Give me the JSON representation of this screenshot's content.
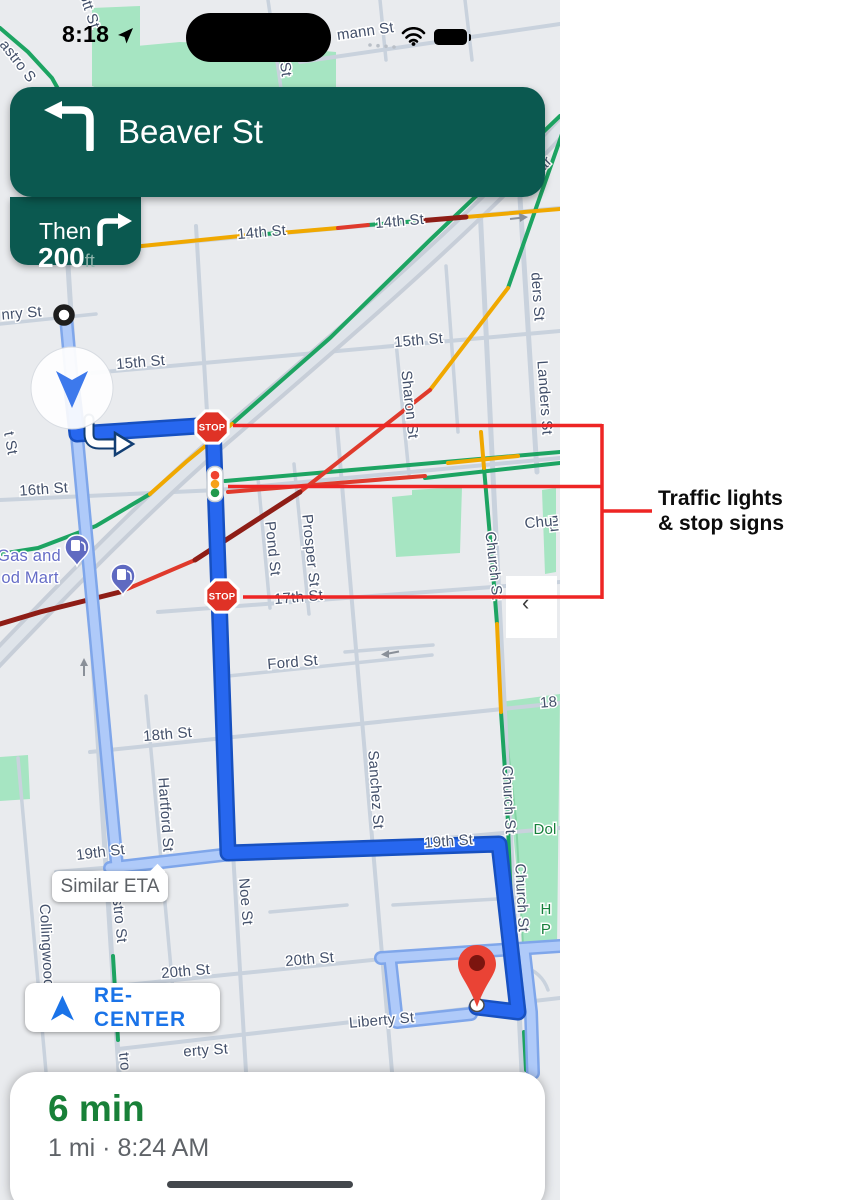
{
  "colors": {
    "banner_green": "#0b5950",
    "route_blue": "#2767ef",
    "alt_route_blue": "#afcaf9",
    "eta_green": "#188038",
    "recenter_blue": "#1a73e8",
    "annotation_red": "#ee2524",
    "traffic_green": "#1da462",
    "traffic_yellow": "#f0a800",
    "traffic_red": "#df3a2c",
    "park_green": "#a6e5c2"
  },
  "status_bar": {
    "time": "8:18"
  },
  "nav_banner": {
    "street": "Beaver St",
    "distance_value": "200",
    "distance_unit": "ft",
    "then_label": "Then"
  },
  "chips": {
    "similar_eta": "Similar ETA",
    "recenter": "RE-CENTER",
    "collapse_glyph": "‹"
  },
  "bottom_sheet": {
    "eta": "6 min",
    "detail": "1 mi · 8:24 AM"
  },
  "annotation": {
    "label_line1": "Traffic lights",
    "label_line2": "& stop signs"
  },
  "map": {
    "stop_sign_label": "STOP",
    "stop_signs": [
      {
        "x": 212,
        "y": 427
      },
      {
        "x": 222,
        "y": 596
      }
    ],
    "traffic_light": {
      "x": 215,
      "y": 484
    },
    "gas_pins": [
      {
        "x": 77,
        "y": 562
      },
      {
        "x": 123,
        "y": 591
      }
    ],
    "street_labels": [
      {
        "t": "ott St",
        "x": 85,
        "y": 12,
        "r": 72
      },
      {
        "t": "St",
        "x": 281,
        "y": 70,
        "r": 82
      },
      {
        "t": "mann St",
        "x": 366,
        "y": 36,
        "r": -8
      },
      {
        "t": "astro S",
        "x": 14,
        "y": 64,
        "r": 52
      },
      {
        "t": "ar",
        "x": 548,
        "y": 167,
        "r": -46
      },
      {
        "t": "14th St",
        "x": 262,
        "y": 237,
        "r": -5
      },
      {
        "t": "14th St",
        "x": 400,
        "y": 226,
        "r": -5
      },
      {
        "t": "ders St",
        "x": 533,
        "y": 297,
        "r": 86
      },
      {
        "t": "nry St",
        "x": 22,
        "y": 318,
        "r": -5
      },
      {
        "t": "15th St",
        "x": 141,
        "y": 367,
        "r": -5
      },
      {
        "t": "15th St",
        "x": 419,
        "y": 345,
        "r": -5
      },
      {
        "t": "Sharon St",
        "x": 405,
        "y": 405,
        "r": 84
      },
      {
        "t": "Landers St",
        "x": 540,
        "y": 398,
        "r": 86
      },
      {
        "t": "t St",
        "x": 6,
        "y": 444,
        "r": 80
      },
      {
        "t": "16th St",
        "x": 44,
        "y": 494,
        "r": -4
      },
      {
        "t": "Pond St",
        "x": 268,
        "y": 549,
        "r": 84
      },
      {
        "t": "Prosper St",
        "x": 306,
        "y": 551,
        "r": 84
      },
      {
        "t": "nu",
        "x": 550,
        "y": 524,
        "r": 84
      },
      {
        "t": "Chu",
        "x": 539,
        "y": 527,
        "r": -5
      },
      {
        "t": "Church St",
        "x": 489,
        "y": 566,
        "r": 84
      },
      {
        "t": "Gas and",
        "x": 29,
        "y": 561,
        "r": 0,
        "cls": "poi"
      },
      {
        "t": "od Mart",
        "x": 30,
        "y": 583,
        "r": 0,
        "cls": "poi"
      },
      {
        "t": "17th St",
        "x": 299,
        "y": 602,
        "r": -5
      },
      {
        "t": "Ford St",
        "x": 293,
        "y": 667,
        "r": -5
      },
      {
        "t": "18th St",
        "x": 168,
        "y": 739,
        "r": -5
      },
      {
        "t": "18",
        "x": 549,
        "y": 707,
        "r": -5
      },
      {
        "t": "Hartford St",
        "x": 161,
        "y": 815,
        "r": 86
      },
      {
        "t": "Sanchez St",
        "x": 371,
        "y": 790,
        "r": 86
      },
      {
        "t": "Church St",
        "x": 504,
        "y": 800,
        "r": 87
      },
      {
        "t": "Church St",
        "x": 517,
        "y": 898,
        "r": 87
      },
      {
        "t": "Dol",
        "x": 545,
        "y": 834,
        "r": 0,
        "cls": "park"
      },
      {
        "t": "H",
        "x": 546,
        "y": 914,
        "r": 0,
        "cls": "park"
      },
      {
        "t": "P",
        "x": 546,
        "y": 934,
        "r": 0,
        "cls": "park"
      },
      {
        "t": "19th St",
        "x": 101,
        "y": 857,
        "r": -7
      },
      {
        "t": "19th St",
        "x": 449,
        "y": 846,
        "r": -4
      },
      {
        "t": "Collingwood",
        "x": 42,
        "y": 946,
        "r": 87
      },
      {
        "t": "stro St",
        "x": 115,
        "y": 921,
        "r": 84
      },
      {
        "t": "Noe St",
        "x": 241,
        "y": 902,
        "r": 85
      },
      {
        "t": "20th St",
        "x": 186,
        "y": 976,
        "r": -5
      },
      {
        "t": "20th St",
        "x": 310,
        "y": 964,
        "r": -5
      },
      {
        "t": "Liberty St",
        "x": 382,
        "y": 1025,
        "r": -5
      },
      {
        "t": "erty St",
        "x": 206,
        "y": 1055,
        "r": -4
      },
      {
        "t": "tro",
        "x": 120,
        "y": 1062,
        "r": 84
      }
    ]
  }
}
